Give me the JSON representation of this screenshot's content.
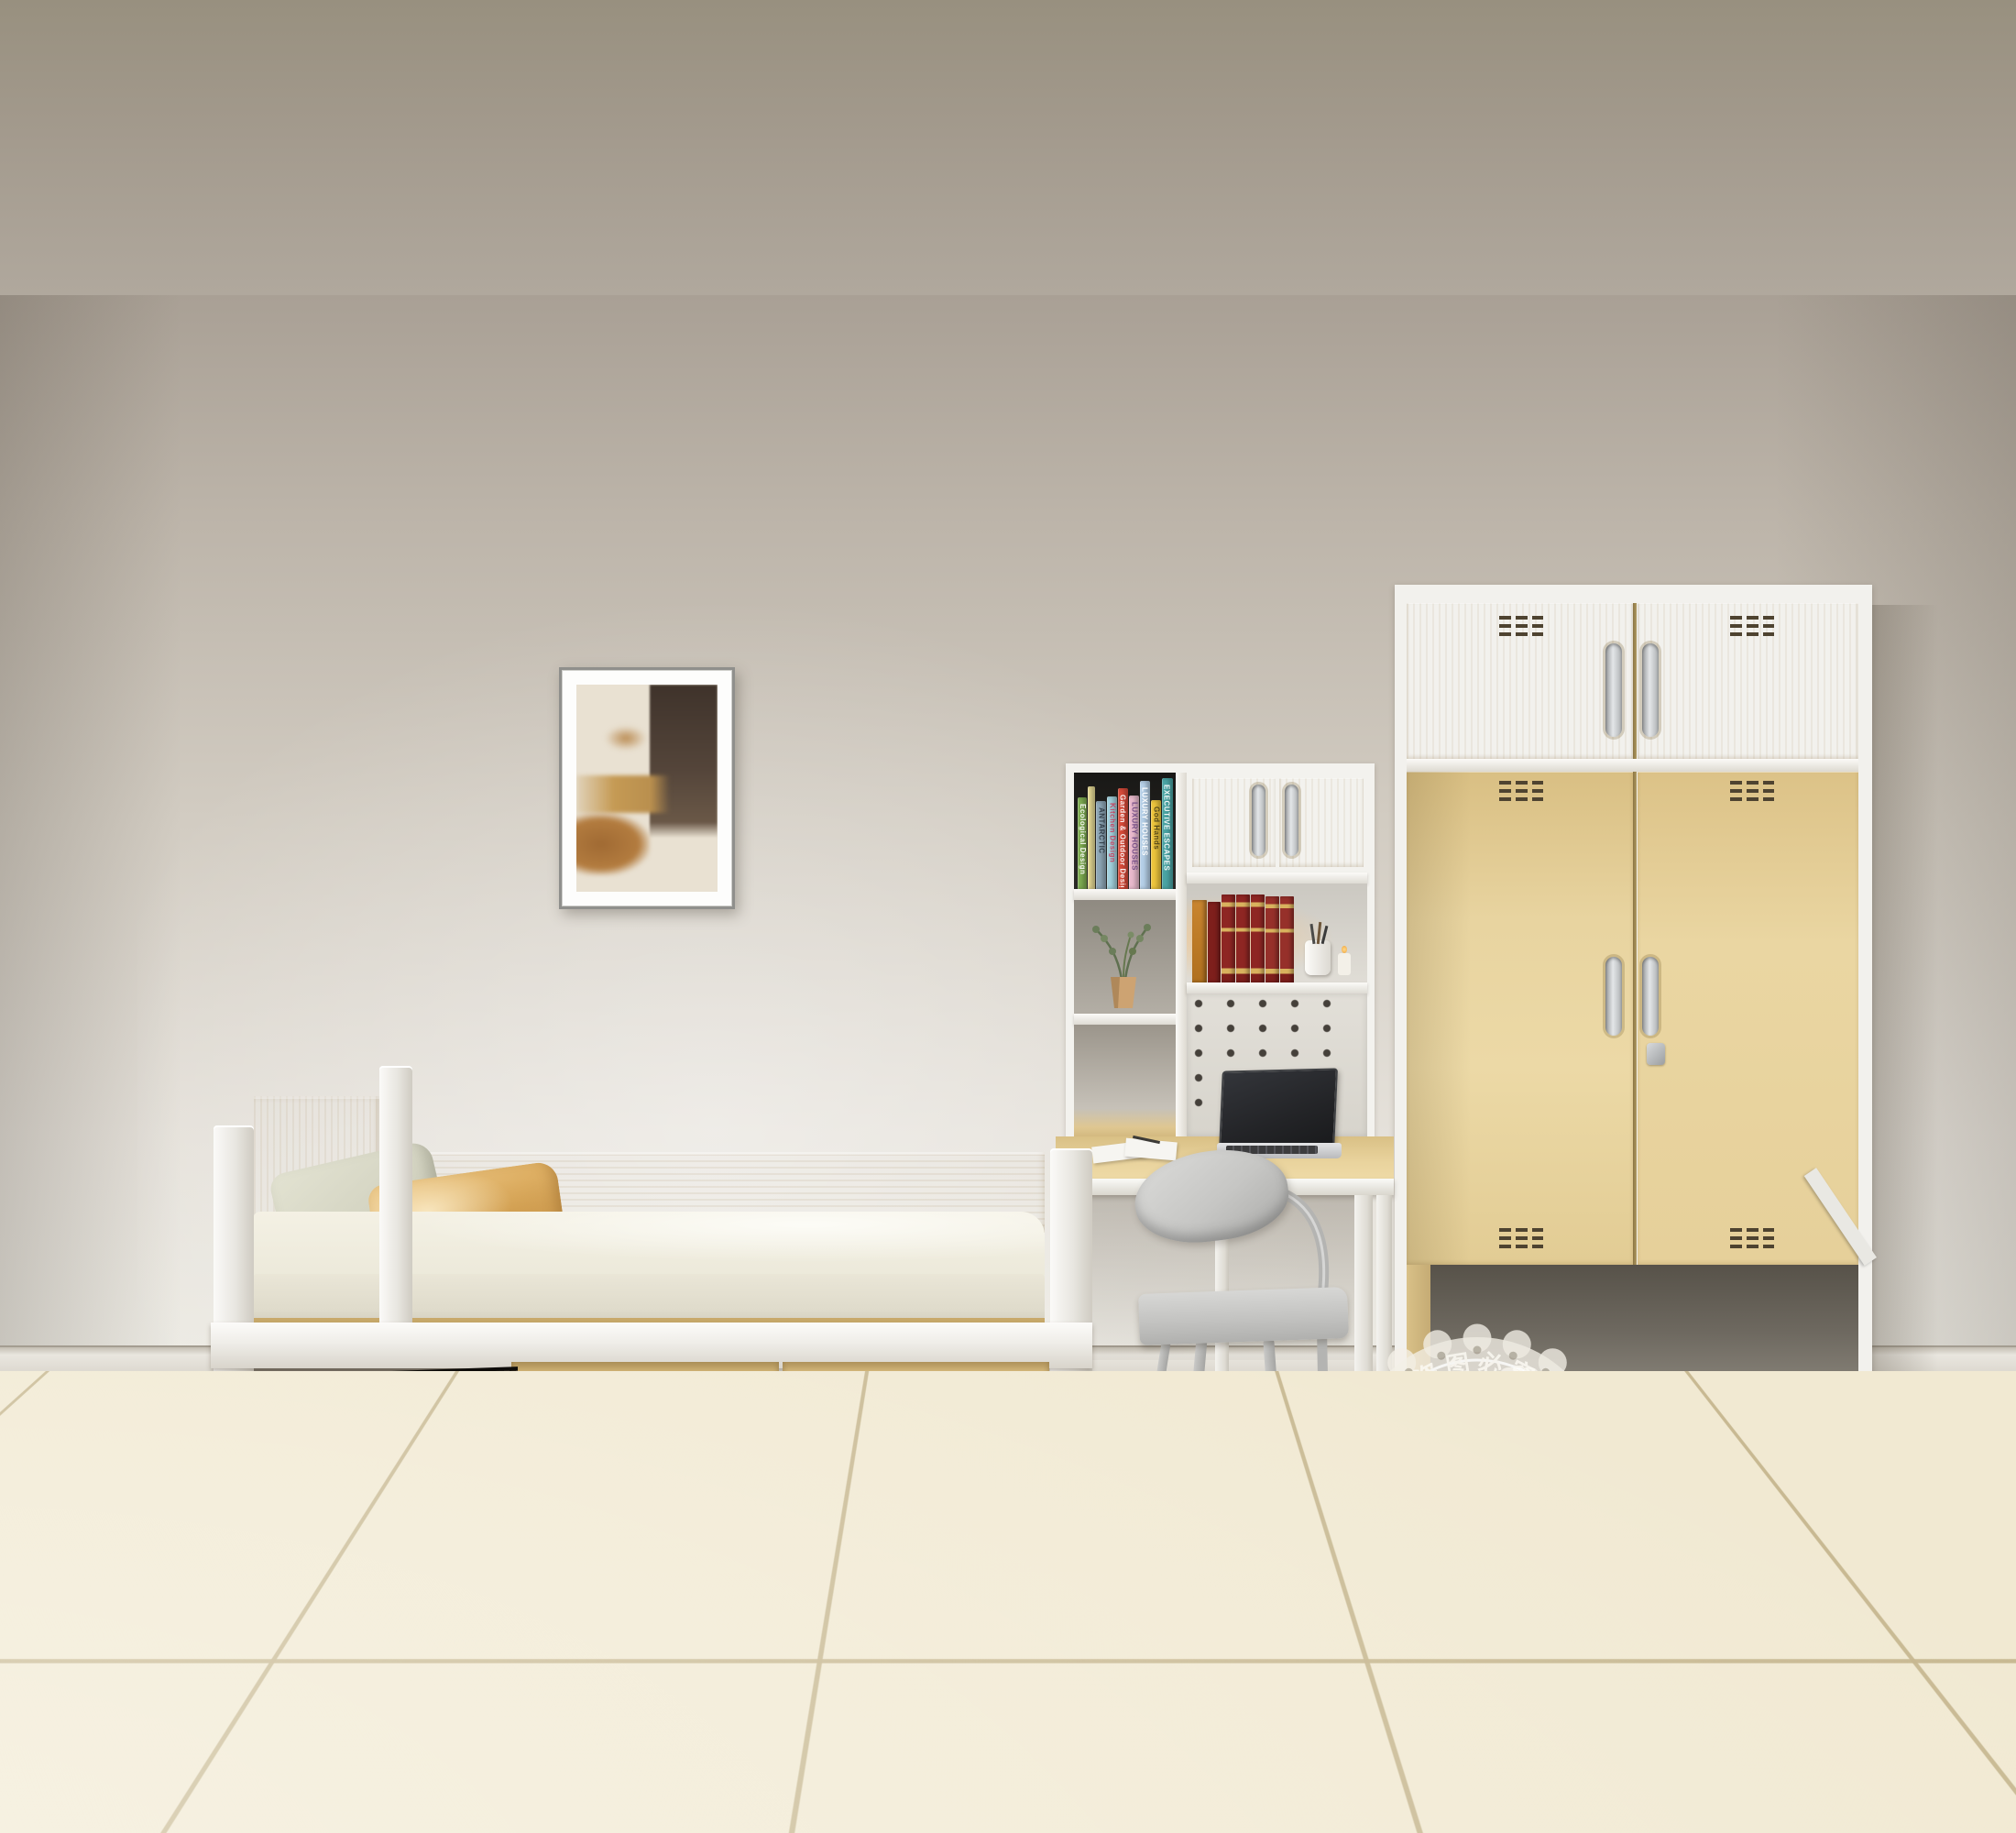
{
  "watermark": {
    "center_line1": "艾尚家具",
    "center_line2": "版权所有",
    "arc_top": "盗图必究",
    "arc_bottom": "盗图必究",
    "arc_left": "实物拍摄",
    "arc_right": "实物拍摄",
    "inner_stars_top": "★ ★ ★",
    "inner_stars_bottom": "★ ★ ★",
    "band_stars_nw": "★ ★ ★",
    "band_stars_ne": "★ ★ ★",
    "band_stars_sw": "★ ★",
    "band_stars_se": "★ ★"
  },
  "hutch": {
    "spine_books": [
      {
        "title": "Ecological Design",
        "style": "width:14px;height:100px;background:#7fae52",
        "title_style": "color:rgba(255,255,255,.9)"
      },
      {
        "title": "",
        "style": "width:12px;height:112px;background:#e8dc96",
        "title_style": "color:rgba(90,90,70,.8)"
      },
      {
        "title": "ANTARCTIC",
        "style": "width:16px;height:96px;background:#8fa8b8",
        "title_style": "color:rgba(40,50,60,.85)"
      },
      {
        "title": "Kitchen Design",
        "style": "width:15px;height:101px;background:#a3d2de",
        "title_style": "color:rgba(200,60,90,.9)"
      },
      {
        "title": "Garden & Outdoor Design",
        "style": "width:17px;height:110px;background:#d84b3a",
        "title_style": "color:rgba(255,255,255,.92)"
      },
      {
        "title": "LUXURY HOUSES",
        "style": "width:15px;height:102px;background:#e9bacd",
        "title_style": "color:rgba(110,70,130,.9)"
      },
      {
        "title": "LUXURY HOUSES",
        "style": "width:17px;height:118px;background:#b6d0e8",
        "title_style": "color:rgba(255,255,255,.95)"
      },
      {
        "title": "God Hands",
        "style": "width:15px;height:97px;background:#eec63d",
        "title_style": "color:rgba(70,60,20,.9)"
      },
      {
        "title": "EXECUTIVE ESCAPES",
        "style": "width:18px;height:121px;background:#4aa4a4",
        "title_style": "color:rgba(255,255,255,.92)"
      }
    ]
  },
  "palette": {
    "wood": "#e5cd96",
    "frame_white": "#f3f2ee",
    "wall": "#d2ccc2",
    "floor_tile": "#f1e9d2",
    "watermark_ink": "#55524d",
    "red_books": "#8e2623",
    "trundle_slats": "#2a241e"
  }
}
